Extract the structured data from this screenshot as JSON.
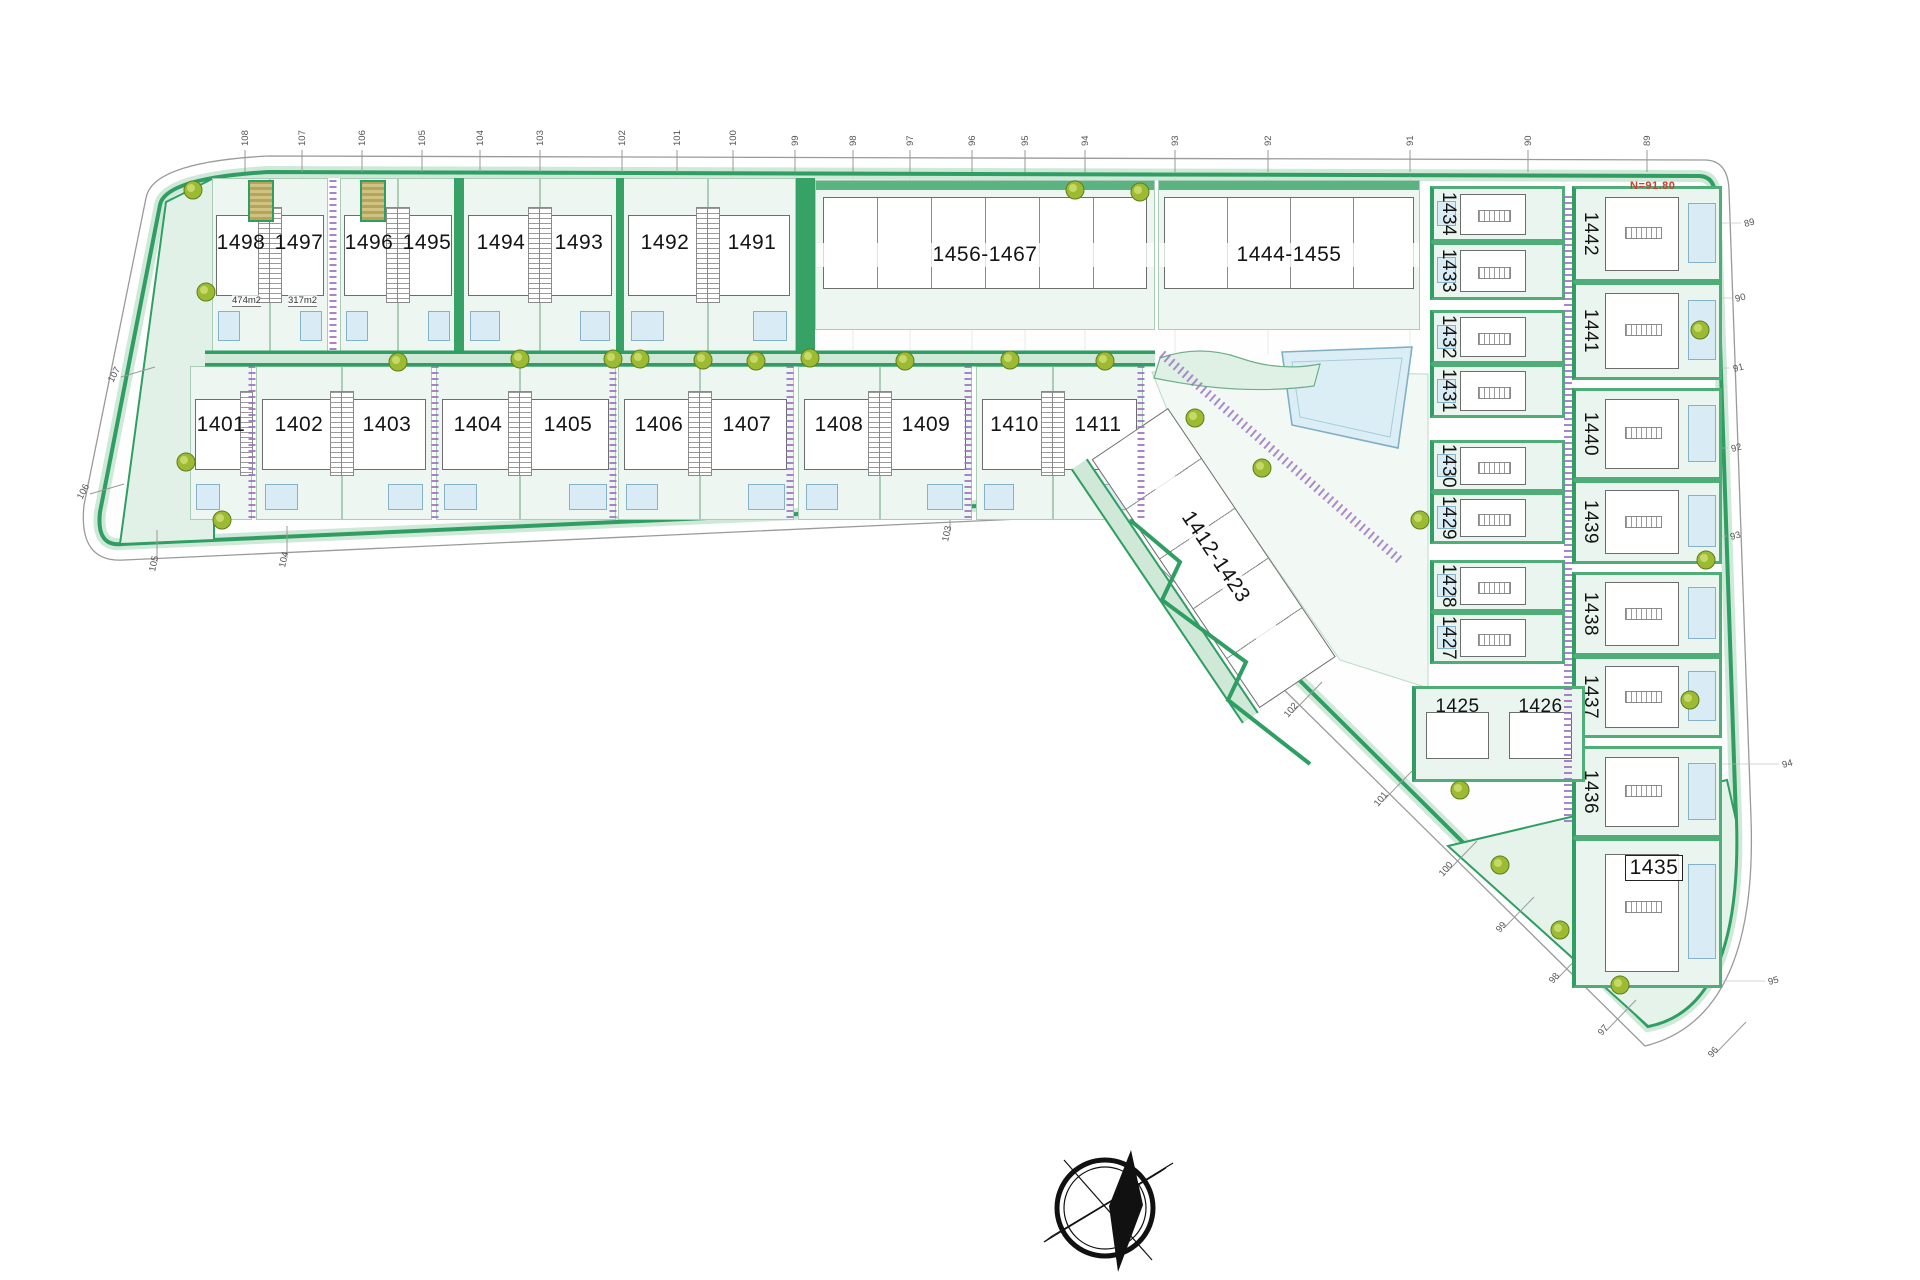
{
  "title": "residential-site-plan",
  "annotations": {
    "level_note": "N=91.80",
    "area_labels": [
      {
        "text": "474m2",
        "x": 232,
        "y": 295
      },
      {
        "text": "317m2",
        "x": 288,
        "y": 295
      }
    ]
  },
  "colors": {
    "green": "#2f9e63",
    "light_green": "#e9f5ee",
    "band_green": "#cfe8d8",
    "pool_blue": "#d9ecf5",
    "purple": "#9b6fc0",
    "tree_olive": "#9cba32",
    "building_gray": "#6d6d6d",
    "note_red": "#d23b2f"
  },
  "row1": {
    "y": 178,
    "h": 174,
    "villas": [
      {
        "id": "1498",
        "x": 212,
        "w": 58,
        "stair": "right",
        "pool": "left"
      },
      {
        "id": "1497",
        "x": 270,
        "w": 58,
        "stair": "left",
        "pool": "right"
      },
      {
        "id": "1496",
        "x": 340,
        "w": 58,
        "stair": "right",
        "pool": "left"
      },
      {
        "id": "1495",
        "x": 398,
        "w": 58,
        "stair": "left",
        "pool": "right"
      },
      {
        "id": "1494",
        "x": 462,
        "w": 78,
        "stair": "right",
        "pool": "left"
      },
      {
        "id": "1493",
        "x": 540,
        "w": 78,
        "stair": "left",
        "pool": "right"
      },
      {
        "id": "1492",
        "x": 622,
        "w": 86,
        "stair": "right",
        "pool": "left"
      },
      {
        "id": "1491",
        "x": 708,
        "w": 88,
        "stair": "left",
        "pool": "right"
      }
    ],
    "blocks": [
      {
        "id": "1456-1467",
        "x": 815,
        "y": 180,
        "w": 340,
        "h": 150,
        "units": 6
      },
      {
        "id": "1444-1455",
        "x": 1158,
        "y": 180,
        "w": 262,
        "h": 150,
        "units": 4
      }
    ]
  },
  "row2": {
    "y": 366,
    "h": 154,
    "villas": [
      {
        "id": "1401",
        "x": 190,
        "w": 62,
        "stair": "right",
        "pool": "left"
      },
      {
        "id": "1402",
        "x": 256,
        "w": 86,
        "stair": "right",
        "pool": "left"
      },
      {
        "id": "1403",
        "x": 342,
        "w": 90,
        "stair": "left",
        "pool": "right"
      },
      {
        "id": "1404",
        "x": 436,
        "w": 84,
        "stair": "right",
        "pool": "left"
      },
      {
        "id": "1405",
        "x": 520,
        "w": 96,
        "stair": "left",
        "pool": "right"
      },
      {
        "id": "1406",
        "x": 618,
        "w": 82,
        "stair": "right",
        "pool": "left"
      },
      {
        "id": "1407",
        "x": 700,
        "w": 94,
        "stair": "left",
        "pool": "right"
      },
      {
        "id": "1408",
        "x": 798,
        "w": 82,
        "stair": "right",
        "pool": "left"
      },
      {
        "id": "1409",
        "x": 880,
        "w": 92,
        "stair": "left",
        "pool": "right"
      },
      {
        "id": "1410",
        "x": 976,
        "w": 77,
        "stair": "right",
        "pool": "left"
      },
      {
        "id": "1411",
        "x": 1053,
        "w": 90,
        "stair": "left",
        "pool": "right"
      }
    ]
  },
  "diagonal_block": {
    "id": "1412-1423",
    "x": 1168,
    "y": 408,
    "len": 300,
    "h": 92,
    "angle": 56,
    "units": 5
  },
  "right_wing": {
    "inner": {
      "x": 1430,
      "w": 135,
      "rows": [
        {
          "id": "1434",
          "y": 186,
          "h": 56
        },
        {
          "id": "1433",
          "y": 242,
          "h": 58
        },
        {
          "id": "1432",
          "y": 310,
          "h": 54
        },
        {
          "id": "1431",
          "y": 364,
          "h": 54
        },
        {
          "id": "1430",
          "y": 440,
          "h": 52
        },
        {
          "id": "1429",
          "y": 492,
          "h": 52
        },
        {
          "id": "1428",
          "y": 560,
          "h": 52
        },
        {
          "id": "1427",
          "y": 612,
          "h": 52
        }
      ],
      "pair": {
        "ids": [
          "1425",
          "1426"
        ],
        "y": 686,
        "h": 96
      }
    },
    "outer": {
      "x": 1572,
      "w": 150,
      "rows": [
        {
          "id": "1442",
          "y": 186,
          "h": 96
        },
        {
          "id": "1441",
          "y": 282,
          "h": 98
        },
        {
          "id": "1440",
          "y": 388,
          "h": 92
        },
        {
          "id": "1439",
          "y": 480,
          "h": 84
        },
        {
          "id": "1438",
          "y": 572,
          "h": 84
        },
        {
          "id": "1437",
          "y": 656,
          "h": 82
        },
        {
          "id": "1436",
          "y": 746,
          "h": 92
        },
        {
          "id": "1435",
          "y": 838,
          "h": 150,
          "boxed": true
        }
      ]
    }
  },
  "ticks": {
    "top": [
      {
        "label": "108",
        "x": 245
      },
      {
        "label": "107",
        "x": 302
      },
      {
        "label": "106",
        "x": 362
      },
      {
        "label": "105",
        "x": 422
      },
      {
        "label": "104",
        "x": 480
      },
      {
        "label": "103",
        "x": 540
      },
      {
        "label": "102",
        "x": 622
      },
      {
        "label": "101",
        "x": 677
      },
      {
        "label": "100",
        "x": 733
      },
      {
        "label": "99",
        "x": 795
      },
      {
        "label": "98",
        "x": 853
      },
      {
        "label": "97",
        "x": 910
      },
      {
        "label": "96",
        "x": 972
      },
      {
        "label": "95",
        "x": 1025
      },
      {
        "label": "94",
        "x": 1085
      },
      {
        "label": "93",
        "x": 1175
      },
      {
        "label": "92",
        "x": 1268
      },
      {
        "label": "91",
        "x": 1410
      },
      {
        "label": "90",
        "x": 1528
      },
      {
        "label": "89",
        "x": 1647
      }
    ],
    "left": [
      {
        "label": "107",
        "x": 113,
        "y": 383
      },
      {
        "label": "106",
        "x": 82,
        "y": 500
      }
    ],
    "bottom": [
      {
        "label": "105",
        "x": 155,
        "y": 572
      },
      {
        "label": "104",
        "x": 285,
        "y": 568
      },
      {
        "label": "103",
        "x": 948,
        "y": 542
      }
    ],
    "diagonal": [
      {
        "label": "102",
        "x": 1288,
        "y": 718
      },
      {
        "label": "101",
        "x": 1378,
        "y": 807
      },
      {
        "label": "100",
        "x": 1443,
        "y": 877
      },
      {
        "label": "99",
        "x": 1500,
        "y": 933
      },
      {
        "label": "98",
        "x": 1553,
        "y": 984
      },
      {
        "label": "97",
        "x": 1602,
        "y": 1036
      },
      {
        "label": "96",
        "x": 1712,
        "y": 1058
      }
    ],
    "right": [
      {
        "label": "89",
        "x": 1745,
        "y": 227
      },
      {
        "label": "90",
        "x": 1736,
        "y": 302
      },
      {
        "label": "91",
        "x": 1734,
        "y": 372
      },
      {
        "label": "92",
        "x": 1732,
        "y": 452
      },
      {
        "label": "93",
        "x": 1731,
        "y": 540
      },
      {
        "label": "94",
        "x": 1783,
        "y": 768
      },
      {
        "label": "95",
        "x": 1769,
        "y": 985
      }
    ]
  },
  "compass": {
    "name": "north-compass",
    "cx": 1105,
    "cy": 1208,
    "r": 48
  }
}
